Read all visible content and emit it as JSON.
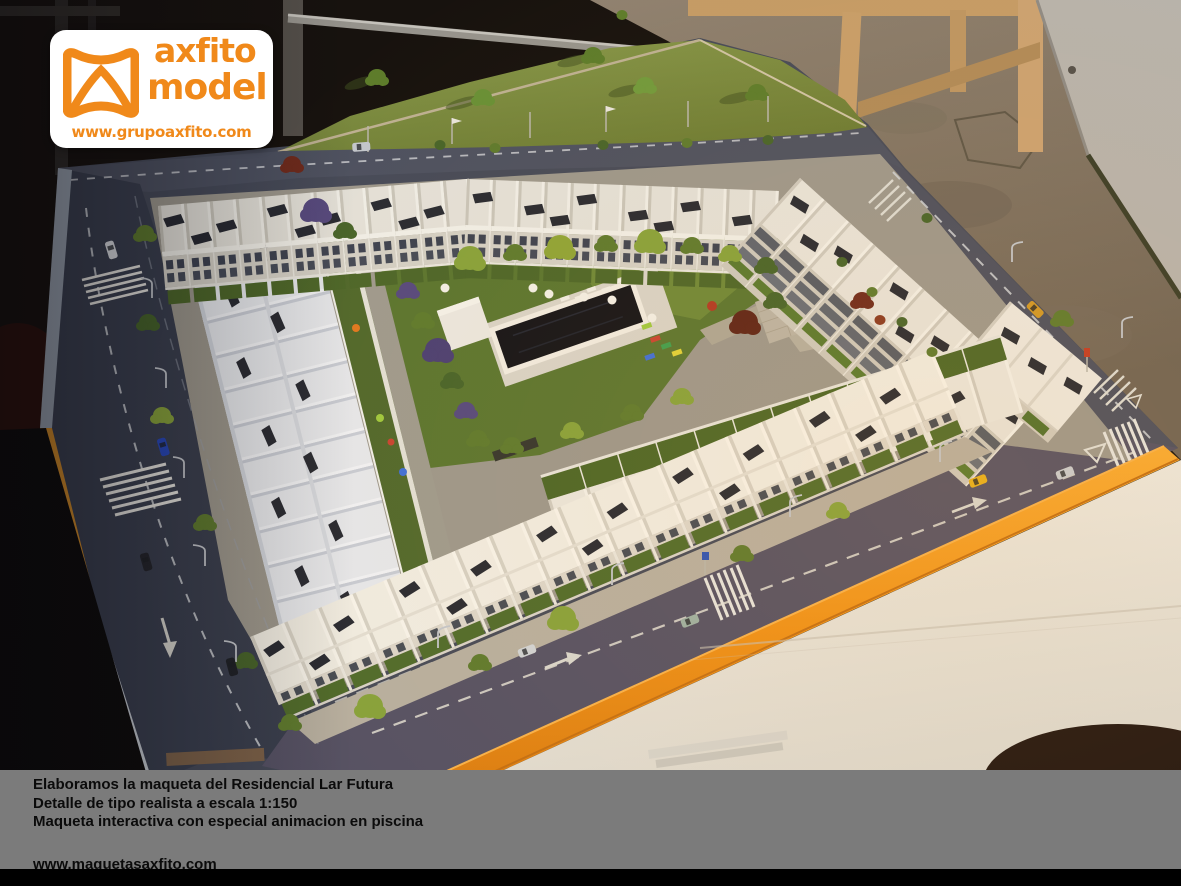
{
  "logo_overlay": {
    "brand_word1": "axfito",
    "brand_word2": "model",
    "website": "www.grupoaxfito.com",
    "brand_color": "#F0891A",
    "background": "#FFFFFF"
  },
  "caption_bar": {
    "background": "#7B7B7B",
    "text_color": "#0B0B0B",
    "lines": [
      "Elaboramos la maqueta del Residencial Lar Futura",
      "Detalle de tipo realista a escala 1:150",
      "Maqueta interactiva con especial animacion en piscina"
    ],
    "website": "www.maquetasaxfito.com"
  },
  "photo": {
    "colors": {
      "model_base_edge_orange": "#F29B1D",
      "street_asphalt": "#46495A",
      "courtyard_lawn": "#5A7530",
      "pool_water": "#131318",
      "house_white": "#EAE7DF",
      "display_table_white": "#E9E5DC",
      "workshop_floor": "#87796A",
      "hill_grass": "#7A8A40"
    }
  }
}
